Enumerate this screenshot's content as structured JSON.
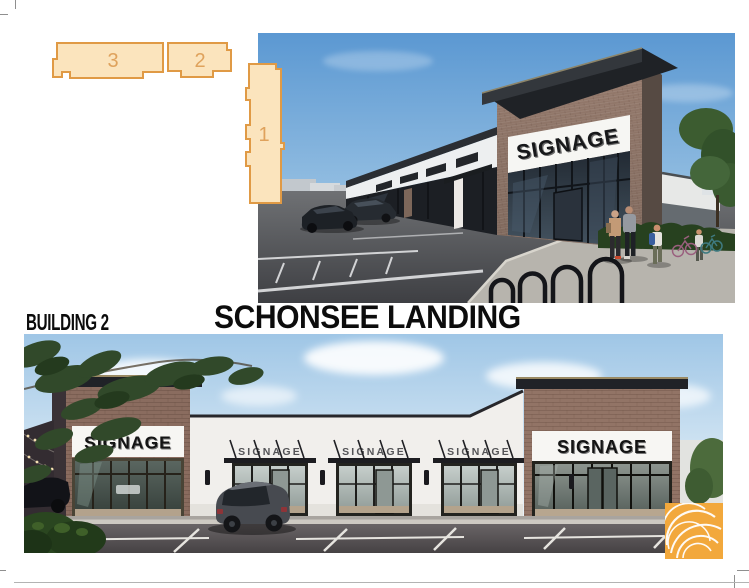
{
  "header": {
    "building_label": "BUILDING 2",
    "project_title": "SCHONSEE LANDING"
  },
  "site_plan": {
    "building_numbers": [
      "3",
      "2",
      "1"
    ]
  },
  "perspective_rendering": {
    "tower_sign": "SIGNAGE"
  },
  "elevation_rendering": {
    "left_tower_sign": "SIGNAGE",
    "canopy_signs": [
      "SIGNAGE",
      "SIGNAGE",
      "SIGNAGE"
    ],
    "right_tower_sign": "SIGNAGE"
  },
  "colors": {
    "site_plan_fill": "#fbe4bd",
    "site_plan_stroke": "#e09a45",
    "site_plan_number": "#dfa25c",
    "logo_background": "#f2a83c",
    "title_text": "#0c0c0c"
  }
}
